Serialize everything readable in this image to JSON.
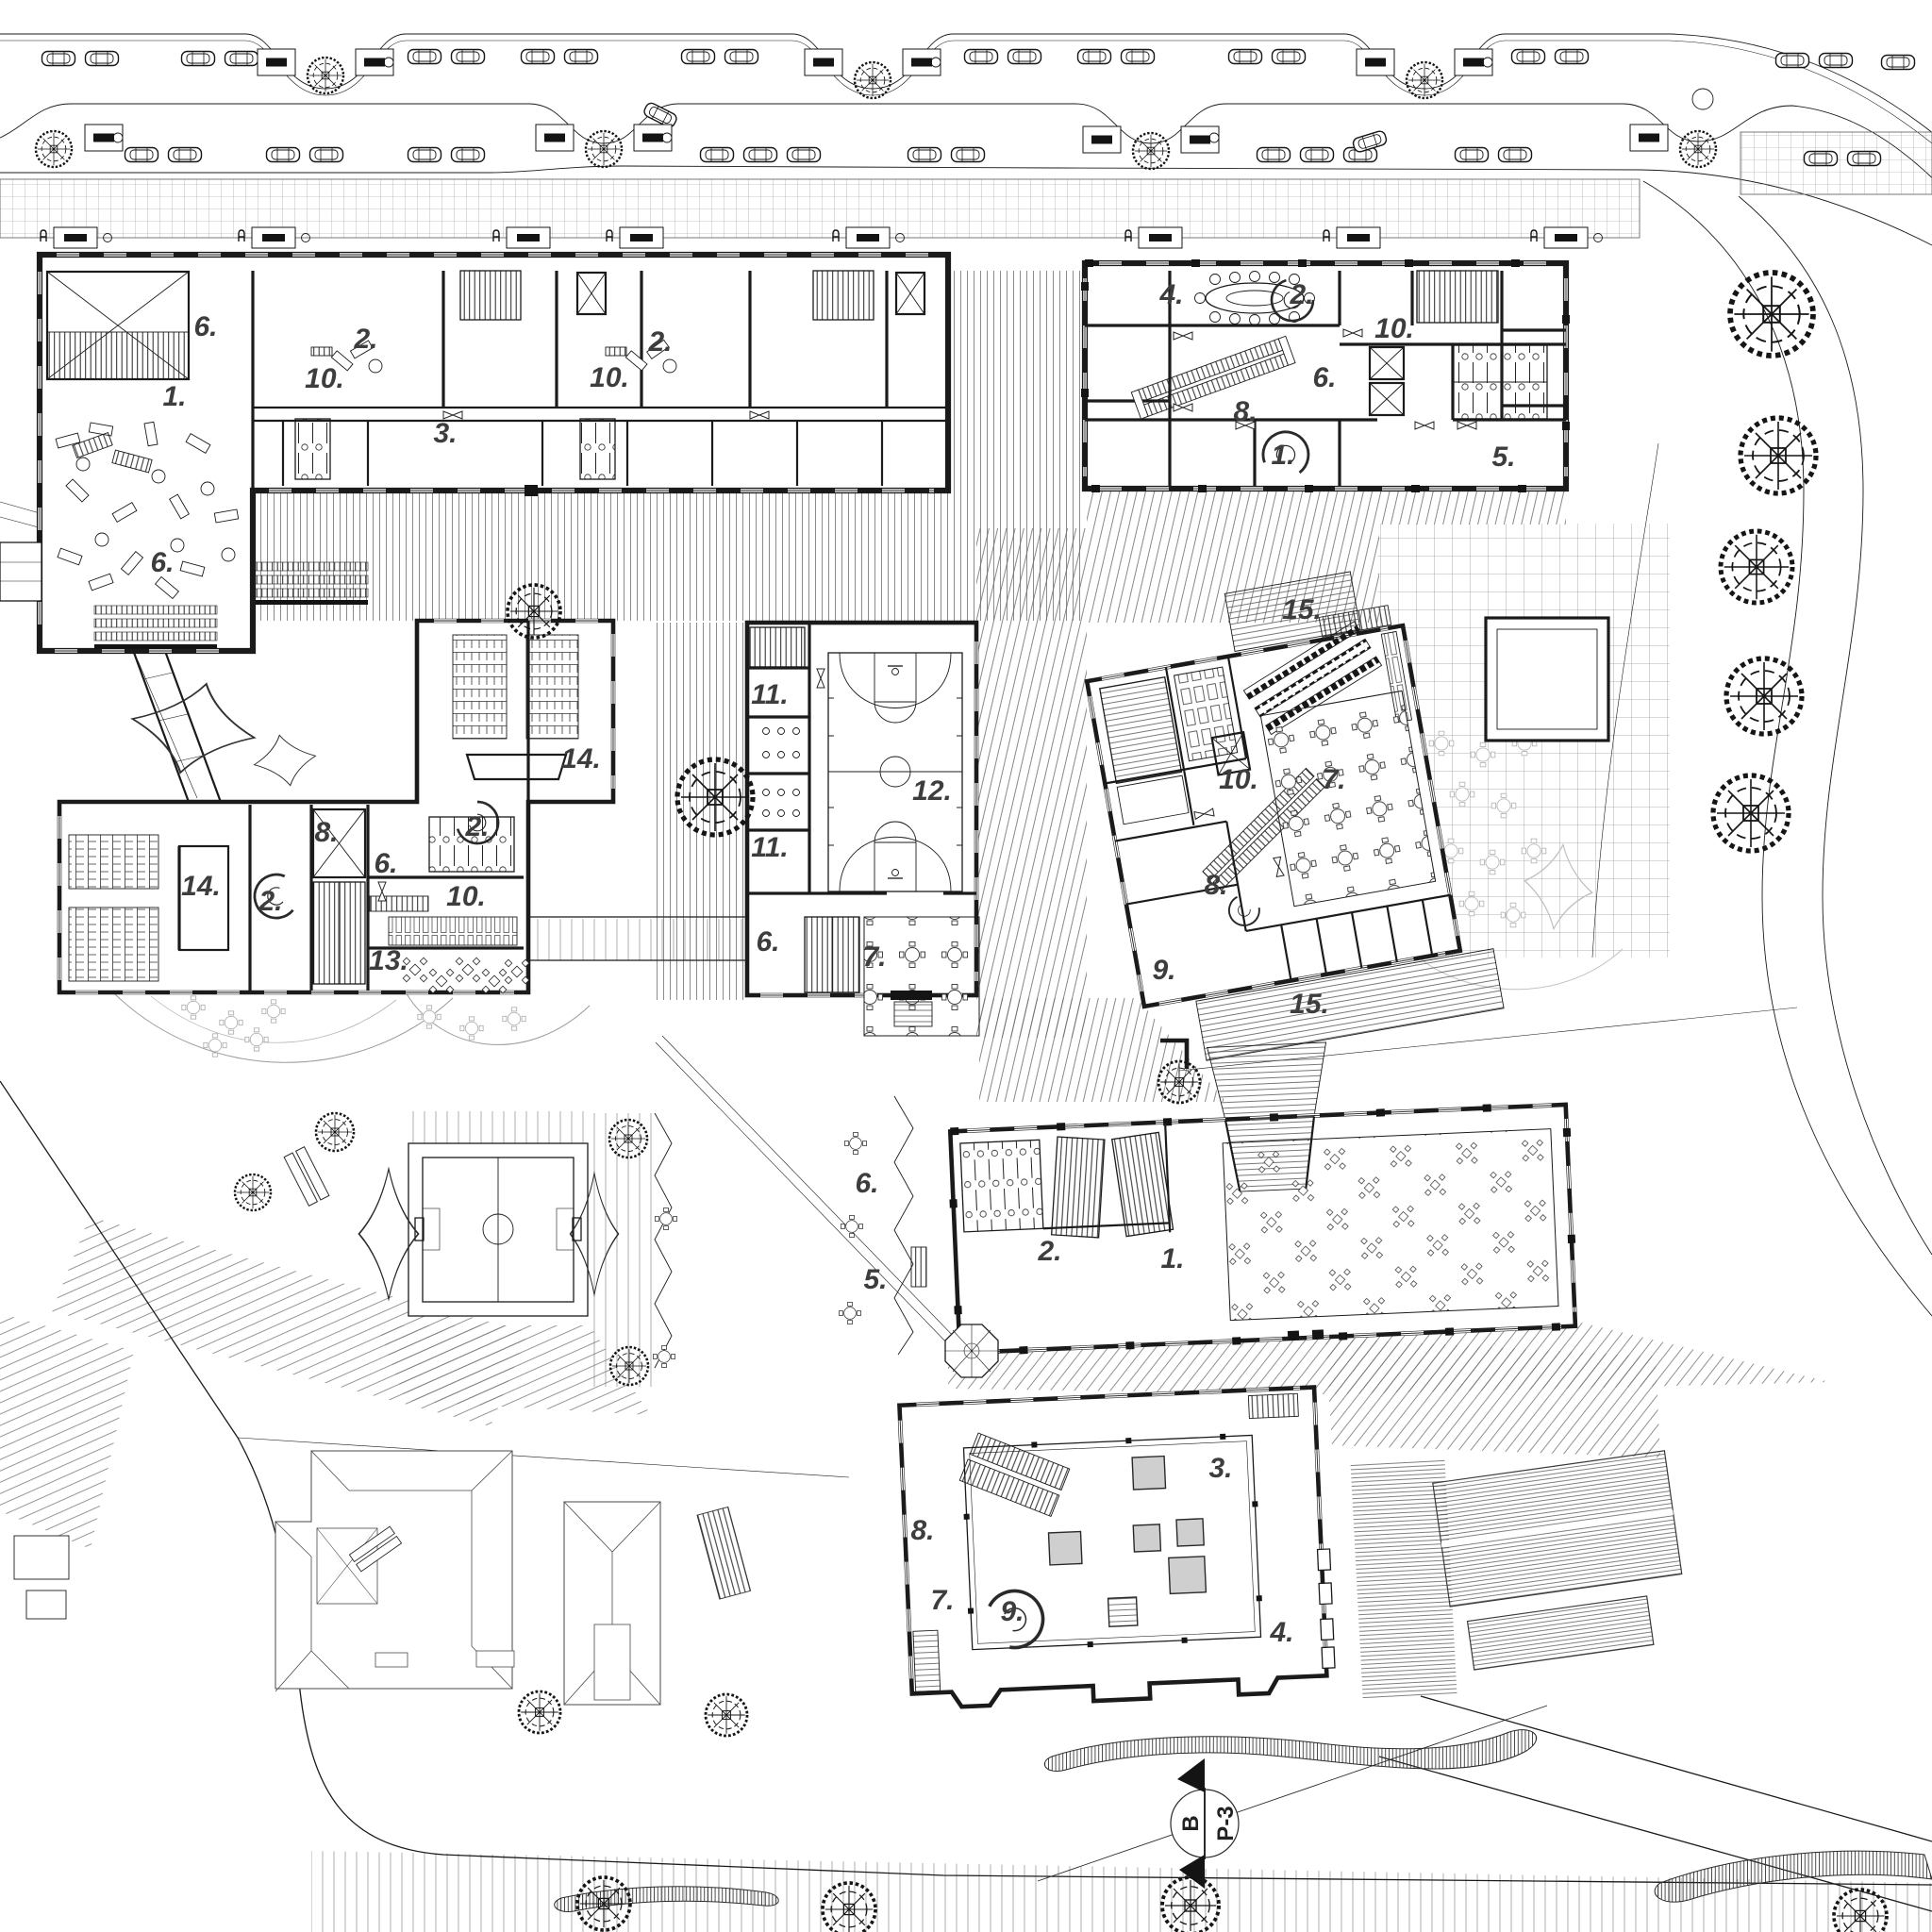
{
  "colors": {
    "paper": "#ffffff",
    "ink": "#1b1b1b",
    "light_ink": "#8a8a8a",
    "label_ink": "#3d3d3d",
    "skylight_gray": "#cfcfcf",
    "ghost_gray": "#bfbfbf"
  },
  "rooms": [
    {
      "building": "nw-teaching-block",
      "number": "6."
    },
    {
      "building": "nw-teaching-block",
      "number": "2."
    },
    {
      "building": "nw-teaching-block",
      "number": "10."
    },
    {
      "building": "nw-teaching-block",
      "number": "1."
    },
    {
      "building": "nw-teaching-block",
      "number": "3."
    },
    {
      "building": "nw-teaching-block",
      "number": "2."
    },
    {
      "building": "nw-teaching-block",
      "number": "10."
    },
    {
      "building": "nw-teaching-block",
      "number": "6."
    },
    {
      "building": "ne-office-block",
      "number": "4."
    },
    {
      "building": "ne-office-block",
      "number": "2."
    },
    {
      "building": "ne-office-block",
      "number": "10."
    },
    {
      "building": "ne-office-block",
      "number": "6."
    },
    {
      "building": "ne-office-block",
      "number": "8."
    },
    {
      "building": "ne-office-block",
      "number": "1."
    },
    {
      "building": "ne-office-block",
      "number": "5."
    },
    {
      "building": "lecture-block",
      "number": "14."
    },
    {
      "building": "lecture-block",
      "number": "2."
    },
    {
      "building": "lecture-block",
      "number": "8."
    },
    {
      "building": "lecture-block",
      "number": "14."
    },
    {
      "building": "lecture-block",
      "number": "2."
    },
    {
      "building": "lecture-block",
      "number": "6."
    },
    {
      "building": "lecture-block",
      "number": "10."
    },
    {
      "building": "lecture-block",
      "number": "13."
    },
    {
      "building": "sports-hall",
      "number": "11."
    },
    {
      "building": "sports-hall",
      "number": "11."
    },
    {
      "building": "sports-hall",
      "number": "12."
    },
    {
      "building": "sports-hall",
      "number": "6."
    },
    {
      "building": "sports-hall",
      "number": "7."
    },
    {
      "building": "canteen-pavilion",
      "number": "15."
    },
    {
      "building": "canteen-pavilion",
      "number": "10."
    },
    {
      "building": "canteen-pavilion",
      "number": "7."
    },
    {
      "building": "canteen-pavilion",
      "number": "8."
    },
    {
      "building": "canteen-pavilion",
      "number": "9."
    },
    {
      "building": "canteen-pavilion",
      "number": "15."
    },
    {
      "building": "dining-hall",
      "number": "6."
    },
    {
      "building": "dining-hall",
      "number": "2."
    },
    {
      "building": "dining-hall",
      "number": "1."
    },
    {
      "building": "dining-hall",
      "number": "5."
    },
    {
      "building": "courtyard-hall",
      "number": "3."
    },
    {
      "building": "courtyard-hall",
      "number": "8."
    },
    {
      "building": "courtyard-hall",
      "number": "7."
    },
    {
      "building": "courtyard-hall",
      "number": "9."
    },
    {
      "building": "courtyard-hall",
      "number": "4."
    }
  ],
  "section_marker": {
    "letter": "B",
    "label": "P-3"
  },
  "symbols": {
    "tree-icon": "dashed double circle with radial branches",
    "car-icon": "top view parked car",
    "parking-meter-icon": "sign board with dark panel",
    "ticket-machine-icon": "kiosk box with dark slot",
    "bench-icon": "paired rectangles",
    "table-with-chairs-icon": "square table with four diagonal chairs",
    "round-table-icon": "round table with four chairs",
    "door-swing-icon": "double triangle door leaves",
    "elevator-icon": "rectangle with X",
    "stairs-icon": "hatched stair run",
    "escalator-icon": "paired hatched runs",
    "spiral-stair-icon": "C shaped arc",
    "skylight-icon": "rectangle with diagonals",
    "basketball-court-icon": "court markings",
    "soccer-pitch-icon": "pitch markings",
    "pergola-icon": "octagon with spokes",
    "canopy-icon": "four point tensile canopy",
    "serpentine-bench-icon": "wavy hatched band",
    "section-marker-icon": "circle with filled triangles on cut line"
  }
}
